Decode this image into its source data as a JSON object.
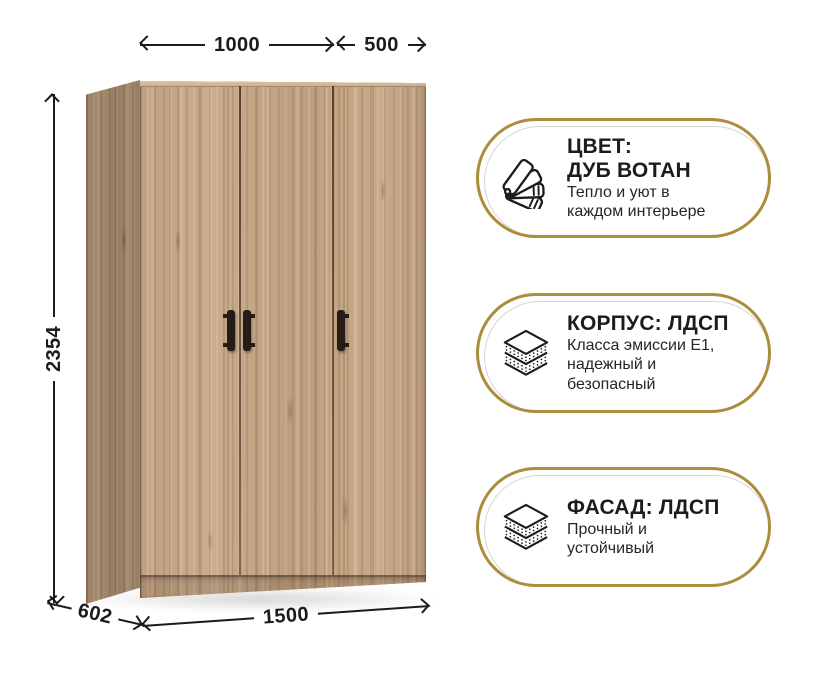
{
  "dimensions": {
    "left_section_width_mm": "1000",
    "right_section_width_mm": "500",
    "height_mm": "2354",
    "depth_mm": "602",
    "total_width_mm": "1500"
  },
  "features": [
    {
      "icon": "color-swatch-fan-icon",
      "title_line1": "ЦВЕТ:",
      "title_line2": "ДУБ ВОТАН",
      "subtitle_line1": "Тепло и уют в",
      "subtitle_line2": "каждом интерьере",
      "subtitle_line3": ""
    },
    {
      "icon": "layers-icon",
      "title_line1": "КОРПУС: ЛДСП",
      "title_line2": "",
      "subtitle_line1": "Класса эмиссии Е1,",
      "subtitle_line2": "надежный и",
      "subtitle_line3": "безопасный"
    },
    {
      "icon": "layers-icon",
      "title_line1": "ФАСАД: ЛДСП",
      "title_line2": "",
      "subtitle_line1": "Прочный и",
      "subtitle_line2": "устойчивый",
      "subtitle_line3": ""
    }
  ],
  "colors": {
    "accent_gold": "#ab8d3c",
    "dimension_line": "#1b1b1b",
    "wood_base": "#c3a484",
    "handle_dark": "#241c15"
  }
}
